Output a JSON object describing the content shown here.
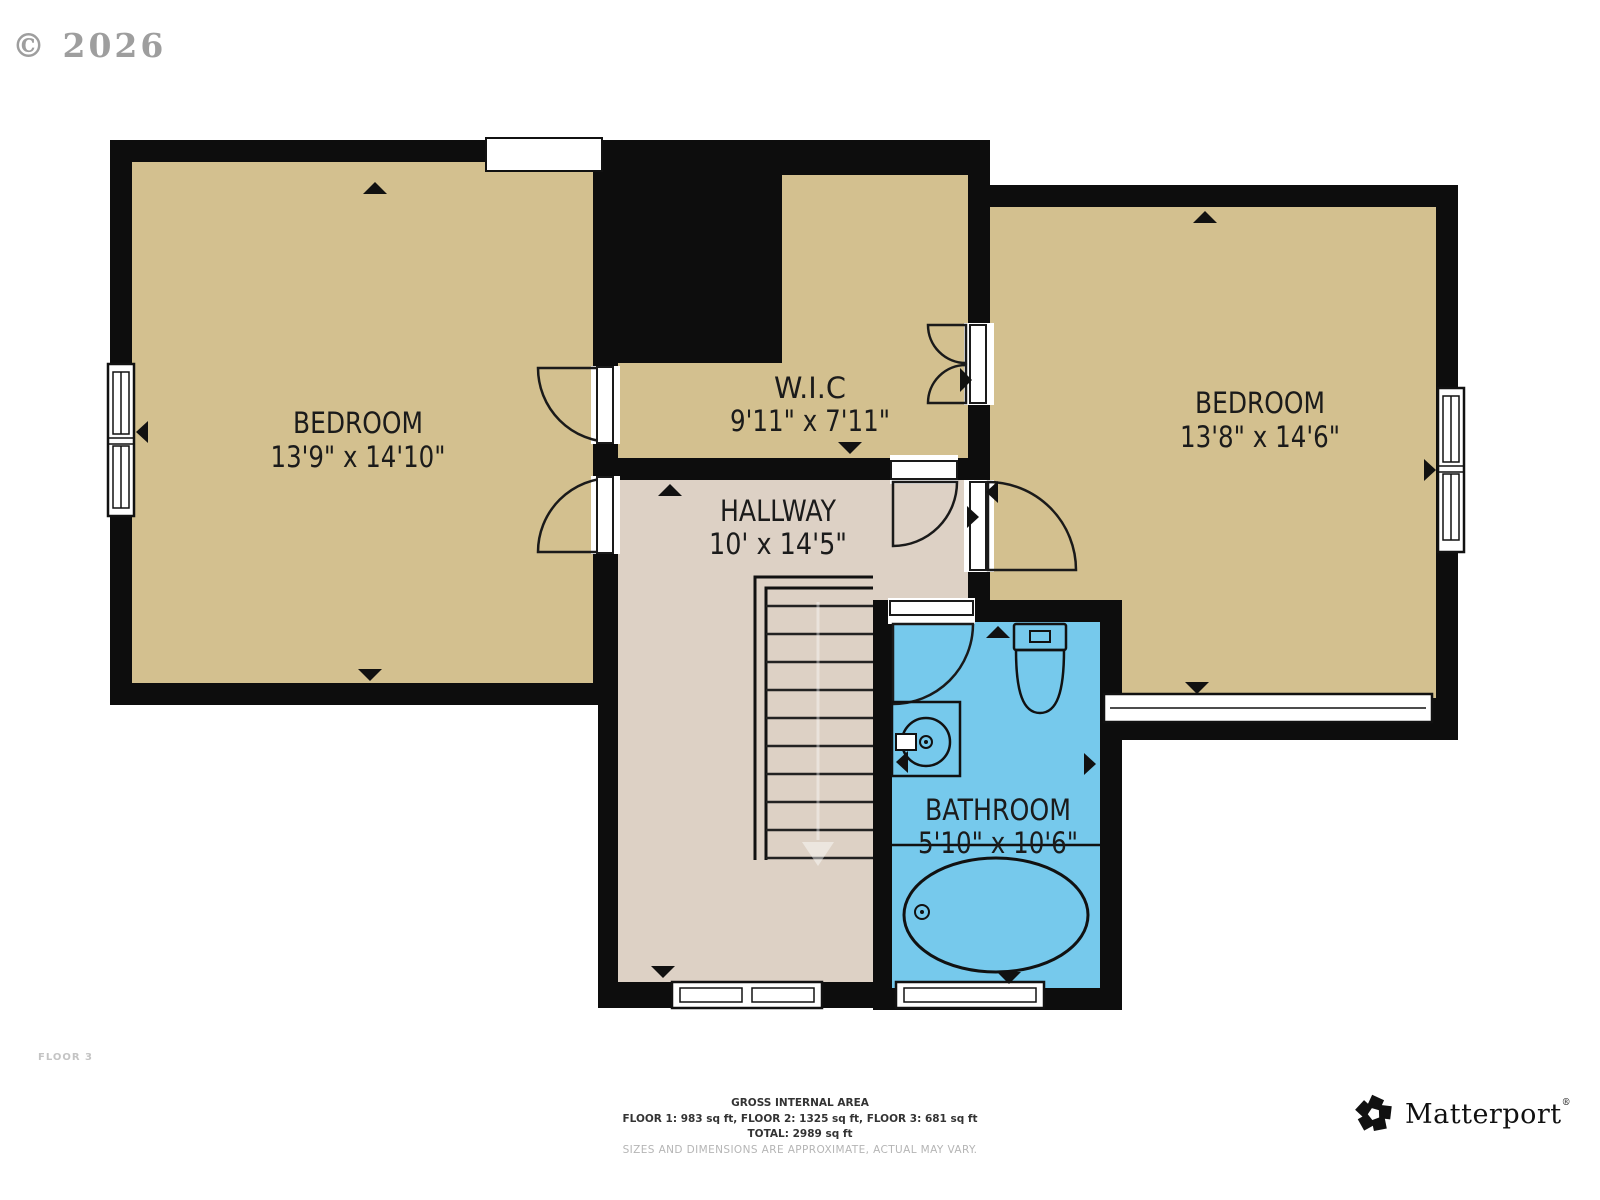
{
  "watermark": "© 2026",
  "floor_label": "FLOOR 3",
  "rooms": [
    {
      "name": "BEDROOM",
      "dimensions": "13'9\" x 14'10\""
    },
    {
      "name": "W.I.C",
      "dimensions": "9'11\" x 7'11\""
    },
    {
      "name": "BEDROOM",
      "dimensions": "13'8\" x 14'6\""
    },
    {
      "name": "HALLWAY",
      "dimensions": "10' x 14'5\""
    },
    {
      "name": "BATHROOM",
      "dimensions": "5'10\" x 10'6\""
    }
  ],
  "footer": {
    "title": "GROSS INTERNAL AREA",
    "floors": "FLOOR 1: 983 sq ft, FLOOR 2: 1325 sq ft, FLOOR 3: 681 sq ft",
    "total": "TOTAL: 2989 sq ft",
    "disclaimer": "SIZES AND DIMENSIONS ARE APPROXIMATE, ACTUAL MAY VARY."
  },
  "branding": {
    "name": "Matterport",
    "registered": "®",
    "logo_icon": "matterport-pinwheel-icon"
  },
  "colors": {
    "wall": "#0d0d0d",
    "room_fill": "#d3c08f",
    "hallway_fill": "#ddd1c5",
    "bathroom_fill": "#76c9ec",
    "background": "#ffffff",
    "watermark_gray": "#8e8e8e",
    "floor_label_gray": "#c4c4c4",
    "footer_text": "#333333",
    "disclaimer_gray": "#b5b5b5",
    "line": "#111111"
  }
}
